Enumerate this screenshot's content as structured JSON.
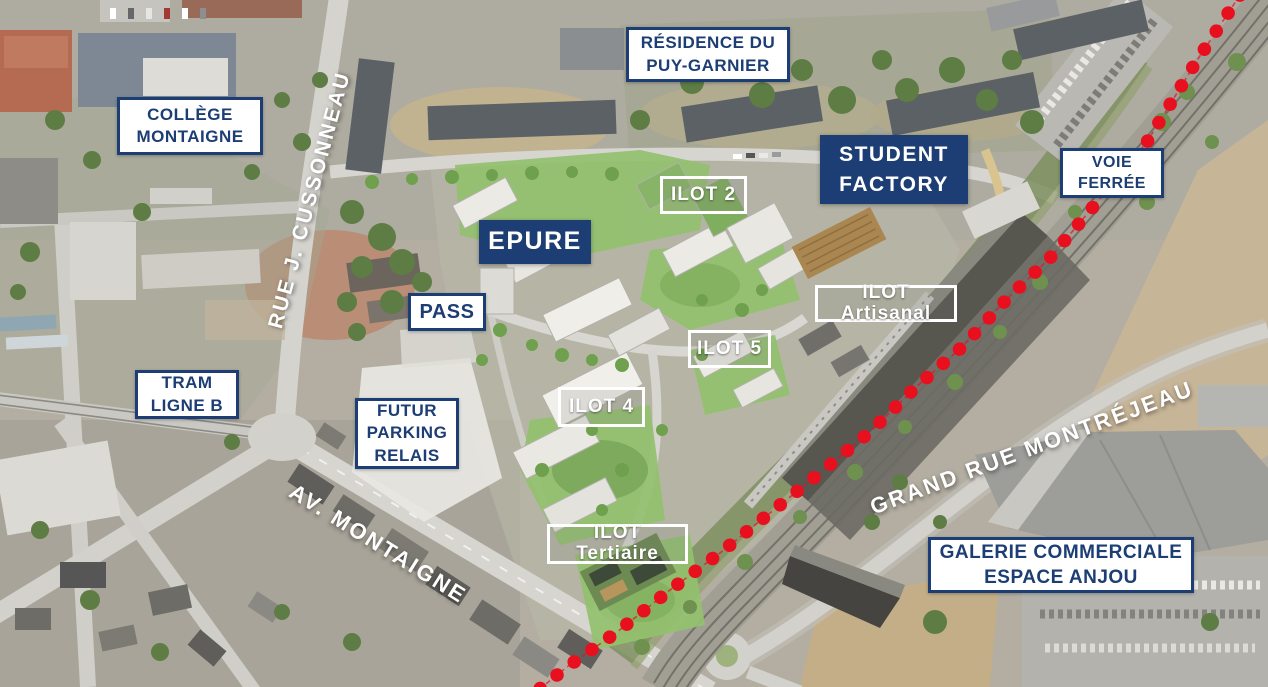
{
  "colors": {
    "accent_blue": "#1c3e74",
    "dot_red": "#e8101f",
    "label_white": "#ffffff"
  },
  "labels": {
    "college_montaigne": {
      "lines": [
        "COLLÈGE",
        "MONTAIGNE"
      ]
    },
    "residence_puy_garnier": {
      "lines": [
        "RÉSIDENCE DU",
        "PUY-GARNIER"
      ]
    },
    "student_factory": {
      "lines": [
        "STUDENT",
        "FACTORY"
      ]
    },
    "voie_ferree": {
      "lines": [
        "VOIE",
        "FERRÉE"
      ]
    },
    "tram_ligne_b": {
      "lines": [
        "TRAM",
        "LIGNE B"
      ]
    },
    "futur_parking_relais": {
      "lines": [
        "FUTUR",
        "PARKING",
        "RELAIS"
      ]
    },
    "galerie_commerciale": {
      "lines": [
        "GALERIE COMMERCIALE",
        "ESPACE ANJOU"
      ]
    },
    "epure": {
      "text": "EPURE"
    },
    "pass": {
      "text": "PASS"
    },
    "ilot_2": {
      "text": "ILOT 2"
    },
    "ilot_4": {
      "text": "ILOT 4"
    },
    "ilot_5": {
      "text": "ILOT 5"
    },
    "ilot_artisanal": {
      "text": "ILOT Artisanal"
    },
    "ilot_tertiaire": {
      "text": "ILOT Tertiaire"
    },
    "rue_cussonneau": {
      "text": "RUE J. CUSSONNEAU"
    },
    "av_montaigne": {
      "text": "AV. MONTAIGNE"
    },
    "grand_rue_montrejeau": {
      "text": "GRAND RUE MONTRÉJEAU"
    }
  }
}
